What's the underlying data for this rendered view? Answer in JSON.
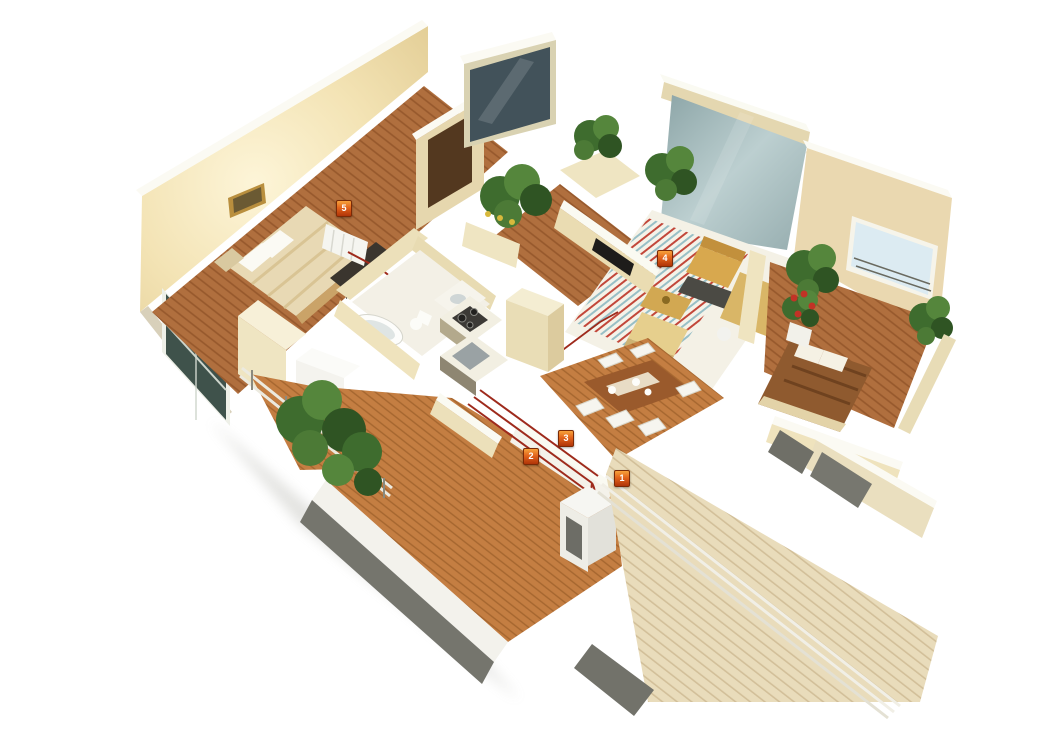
{
  "scene": {
    "kind": "3d-isometric-apartment-floor-plan",
    "background": "#ffffff"
  },
  "markers": [
    {
      "number": "1",
      "name": "boiler-unit-marker"
    },
    {
      "number": "2",
      "name": "return-pipe-marker"
    },
    {
      "number": "3",
      "name": "supply-pipe-marker"
    },
    {
      "number": "4",
      "name": "floor-heating-circuit-marker"
    },
    {
      "number": "5",
      "name": "radiator-marker"
    }
  ],
  "palette": {
    "background": "#ffffff",
    "wall_cream": "#eee1ba",
    "wall_top_white": "#fbfaf3",
    "wood_floor": "#b06f3e",
    "corridor_floor": "#c47e42",
    "deck_wood": "#e9dcbb",
    "heating_red": "#c2473a",
    "heating_blue": "#98bfc6",
    "pipe_red": "#9e2a1c",
    "marker_orange": "#e2641c",
    "plant_green": "#4c7a36",
    "glass_teal": "#9fb5b7",
    "shadow_gray": "#72726a"
  }
}
